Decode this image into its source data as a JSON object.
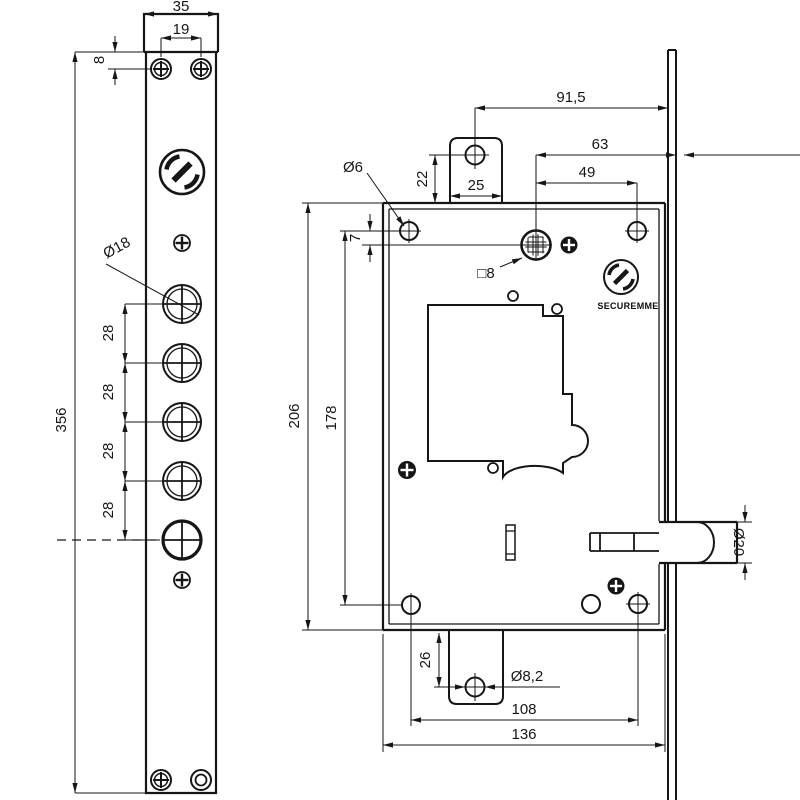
{
  "drawing": {
    "brand": "SECUREMME",
    "faceplate": {
      "width": "35",
      "screw_spacing": "19",
      "screw_offset": "8",
      "cylinder_hole_diameter": "Ø18",
      "hole_pitch": "28",
      "length": "356"
    },
    "body": {
      "tab_to_faceplate": "91,5",
      "cylinder_to_faceplate": "63",
      "screw_to_cylinder": "49",
      "tab_width": "25",
      "tab_hole_offset": "22",
      "screw_hole_diameter": "Ø6",
      "cylinder_top_offset": "7",
      "spindle_square": "□8",
      "height": "206",
      "screw_span_vertical": "178",
      "bottom_tab_hole_offset": "26",
      "bottom_tab_hole_diameter": "Ø8,2",
      "screw_span_horizontal": "108",
      "width": "136",
      "bolt_diameter": "Ø20"
    }
  }
}
